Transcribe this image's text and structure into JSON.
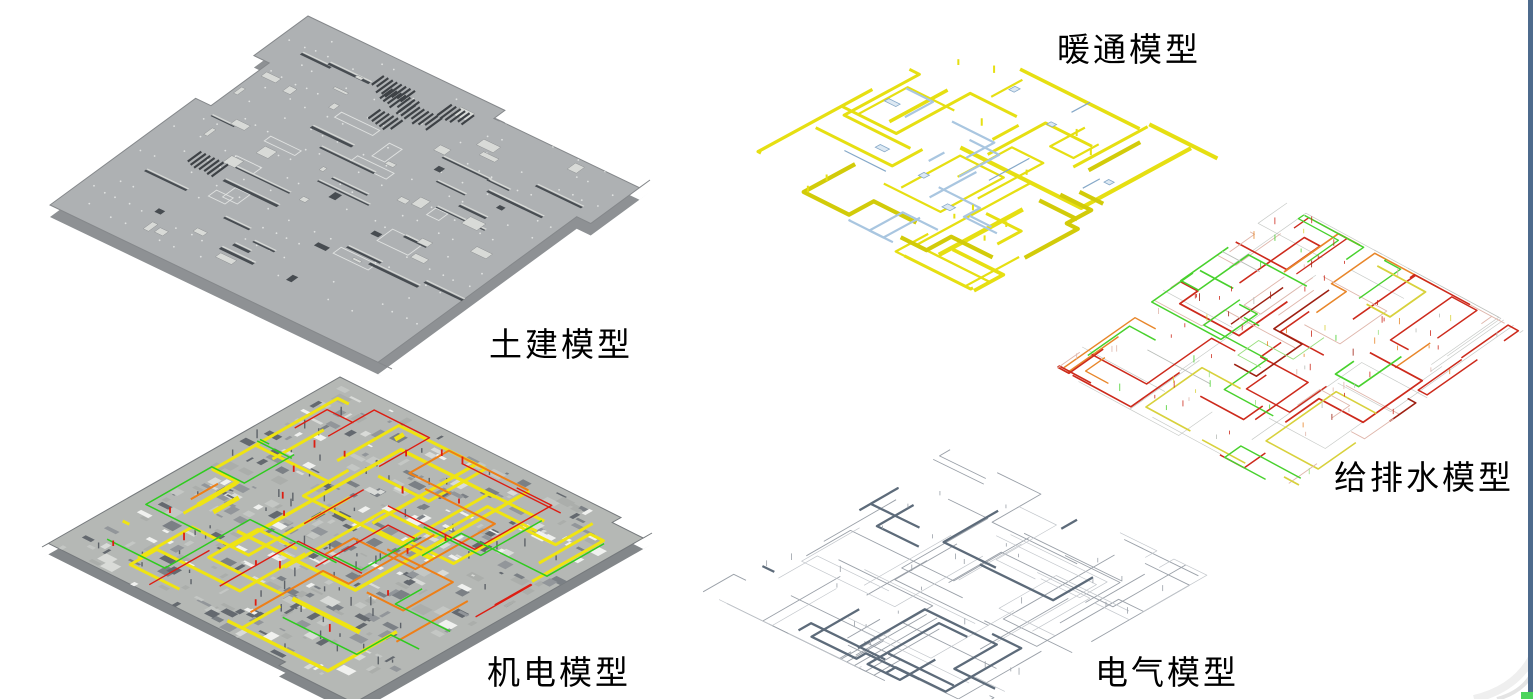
{
  "page": {
    "background": "#ffffff"
  },
  "panels": {
    "civil": {
      "label": "土建模型",
      "palette": {
        "slab": "#aeb1b3",
        "side": "#8e9194",
        "edge": "#85888b",
        "dot": "#e0e2e1",
        "light": "#d8dad7",
        "dark": "#474c51",
        "hatch": "#3e4246"
      }
    },
    "mep": {
      "label": "机电模型",
      "palette": {
        "deck": "#b5b8b5",
        "side": "#83878a",
        "edge": "#75797c",
        "grays": [
          "#f0f1ef",
          "#d9dbd8",
          "#c4c7c4",
          "#abaeab",
          "#92969a",
          "#7b8085",
          "#64696f"
        ],
        "yellow": "#efe412",
        "green": "#2ecb1e",
        "red": "#dd1d12",
        "orange": "#ee7f17",
        "column": "#5d6268"
      }
    },
    "hvac": {
      "label": "暖通模型",
      "palette": {
        "yellow": "#e6df12",
        "yellow_dark": "#d2cb09",
        "blue": "#a9c6e0",
        "blue_dark": "#85a8c8",
        "blue_fill": "#dde9f3"
      }
    },
    "plumbing": {
      "label": "给排水模型",
      "palette": {
        "red": "#cd2a1c",
        "dark_red": "#9e2012",
        "green": "#48d12d",
        "light_green": "#9adf7f",
        "orange": "#e8862a",
        "yellow": "#d8d13c",
        "pale": "#dfb6ab",
        "gray": "#b9bdb9"
      }
    },
    "electrical": {
      "label": "电气模型",
      "palette": {
        "wire": "#9aa0a8",
        "wire_light": "#c3c7cc",
        "tray": "#5d6b7a"
      }
    }
  },
  "decor": {
    "edge_bar": "#4e6b8d",
    "corner_green": "#4cd45e",
    "arc_outer": "#efefef",
    "arc_inner": "#e4e4e4"
  }
}
